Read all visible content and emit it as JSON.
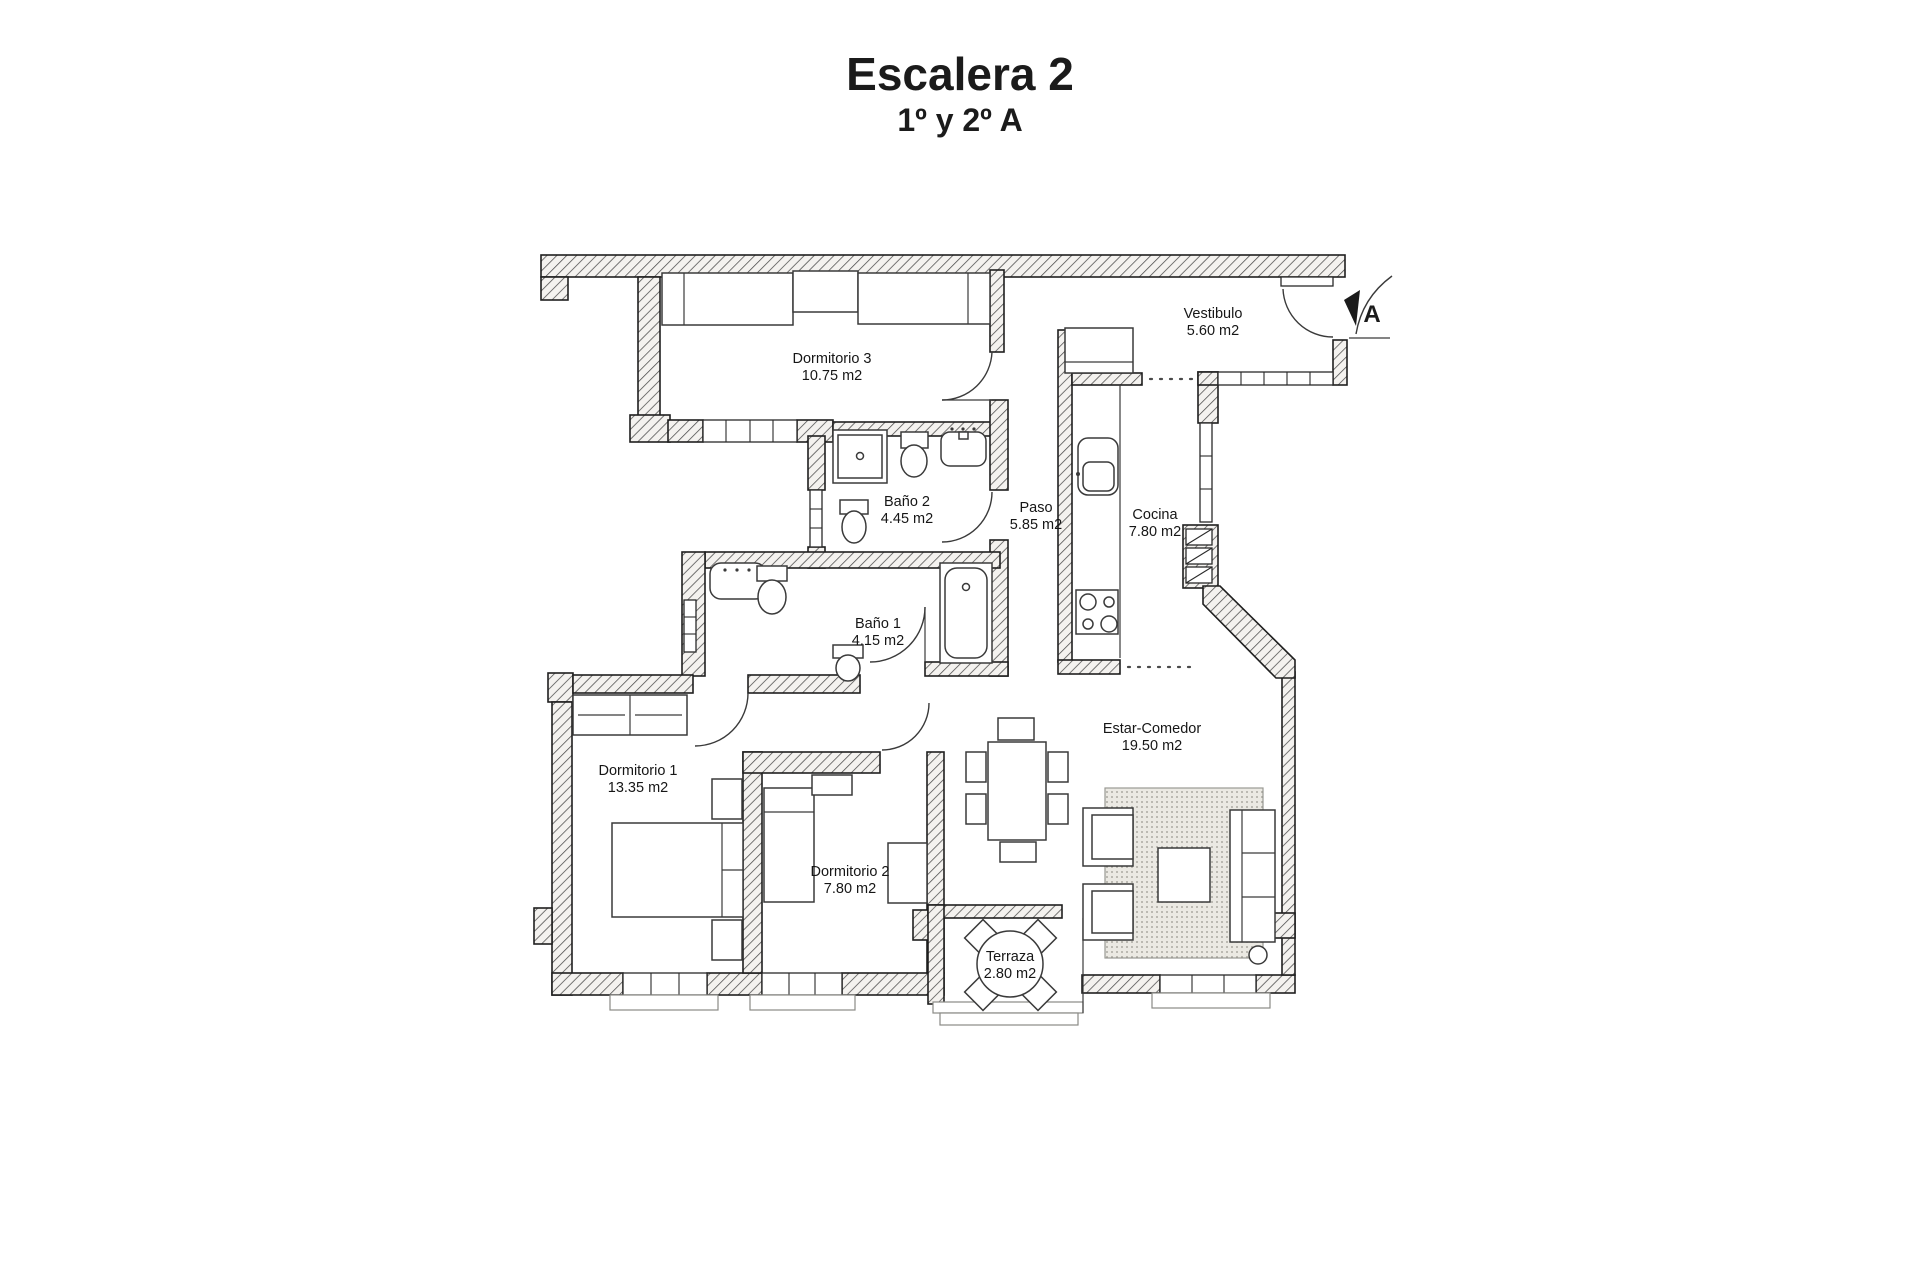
{
  "header": {
    "title": "Escalera 2",
    "subtitle": "1º y 2º A"
  },
  "entrance": {
    "marker": "A"
  },
  "rooms": {
    "dormitorio3": {
      "name": "Dormitorio 3",
      "area": "10.75 m2"
    },
    "vestibulo": {
      "name": "Vestibulo",
      "area": "5.60 m2"
    },
    "bano2": {
      "name": "Baño 2",
      "area": "4.45 m2"
    },
    "paso": {
      "name": "Paso",
      "area": "5.85 m2"
    },
    "cocina": {
      "name": "Cocina",
      "area": "7.80 m2"
    },
    "bano1": {
      "name": "Baño 1",
      "area": "4.15 m2"
    },
    "dormitorio1": {
      "name": "Dormitorio 1",
      "area": "13.35 m2"
    },
    "dormitorio2": {
      "name": "Dormitorio 2",
      "area": "7.80 m2"
    },
    "estar_comedor": {
      "name": "Estar-Comedor",
      "area": "19.50 m2"
    },
    "terraza": {
      "name": "Terraza",
      "area": "2.80 m2"
    }
  },
  "colors": {
    "paper": "#ffffff",
    "ink": "#1f1f1f",
    "hatch": "#4a4a4a"
  }
}
